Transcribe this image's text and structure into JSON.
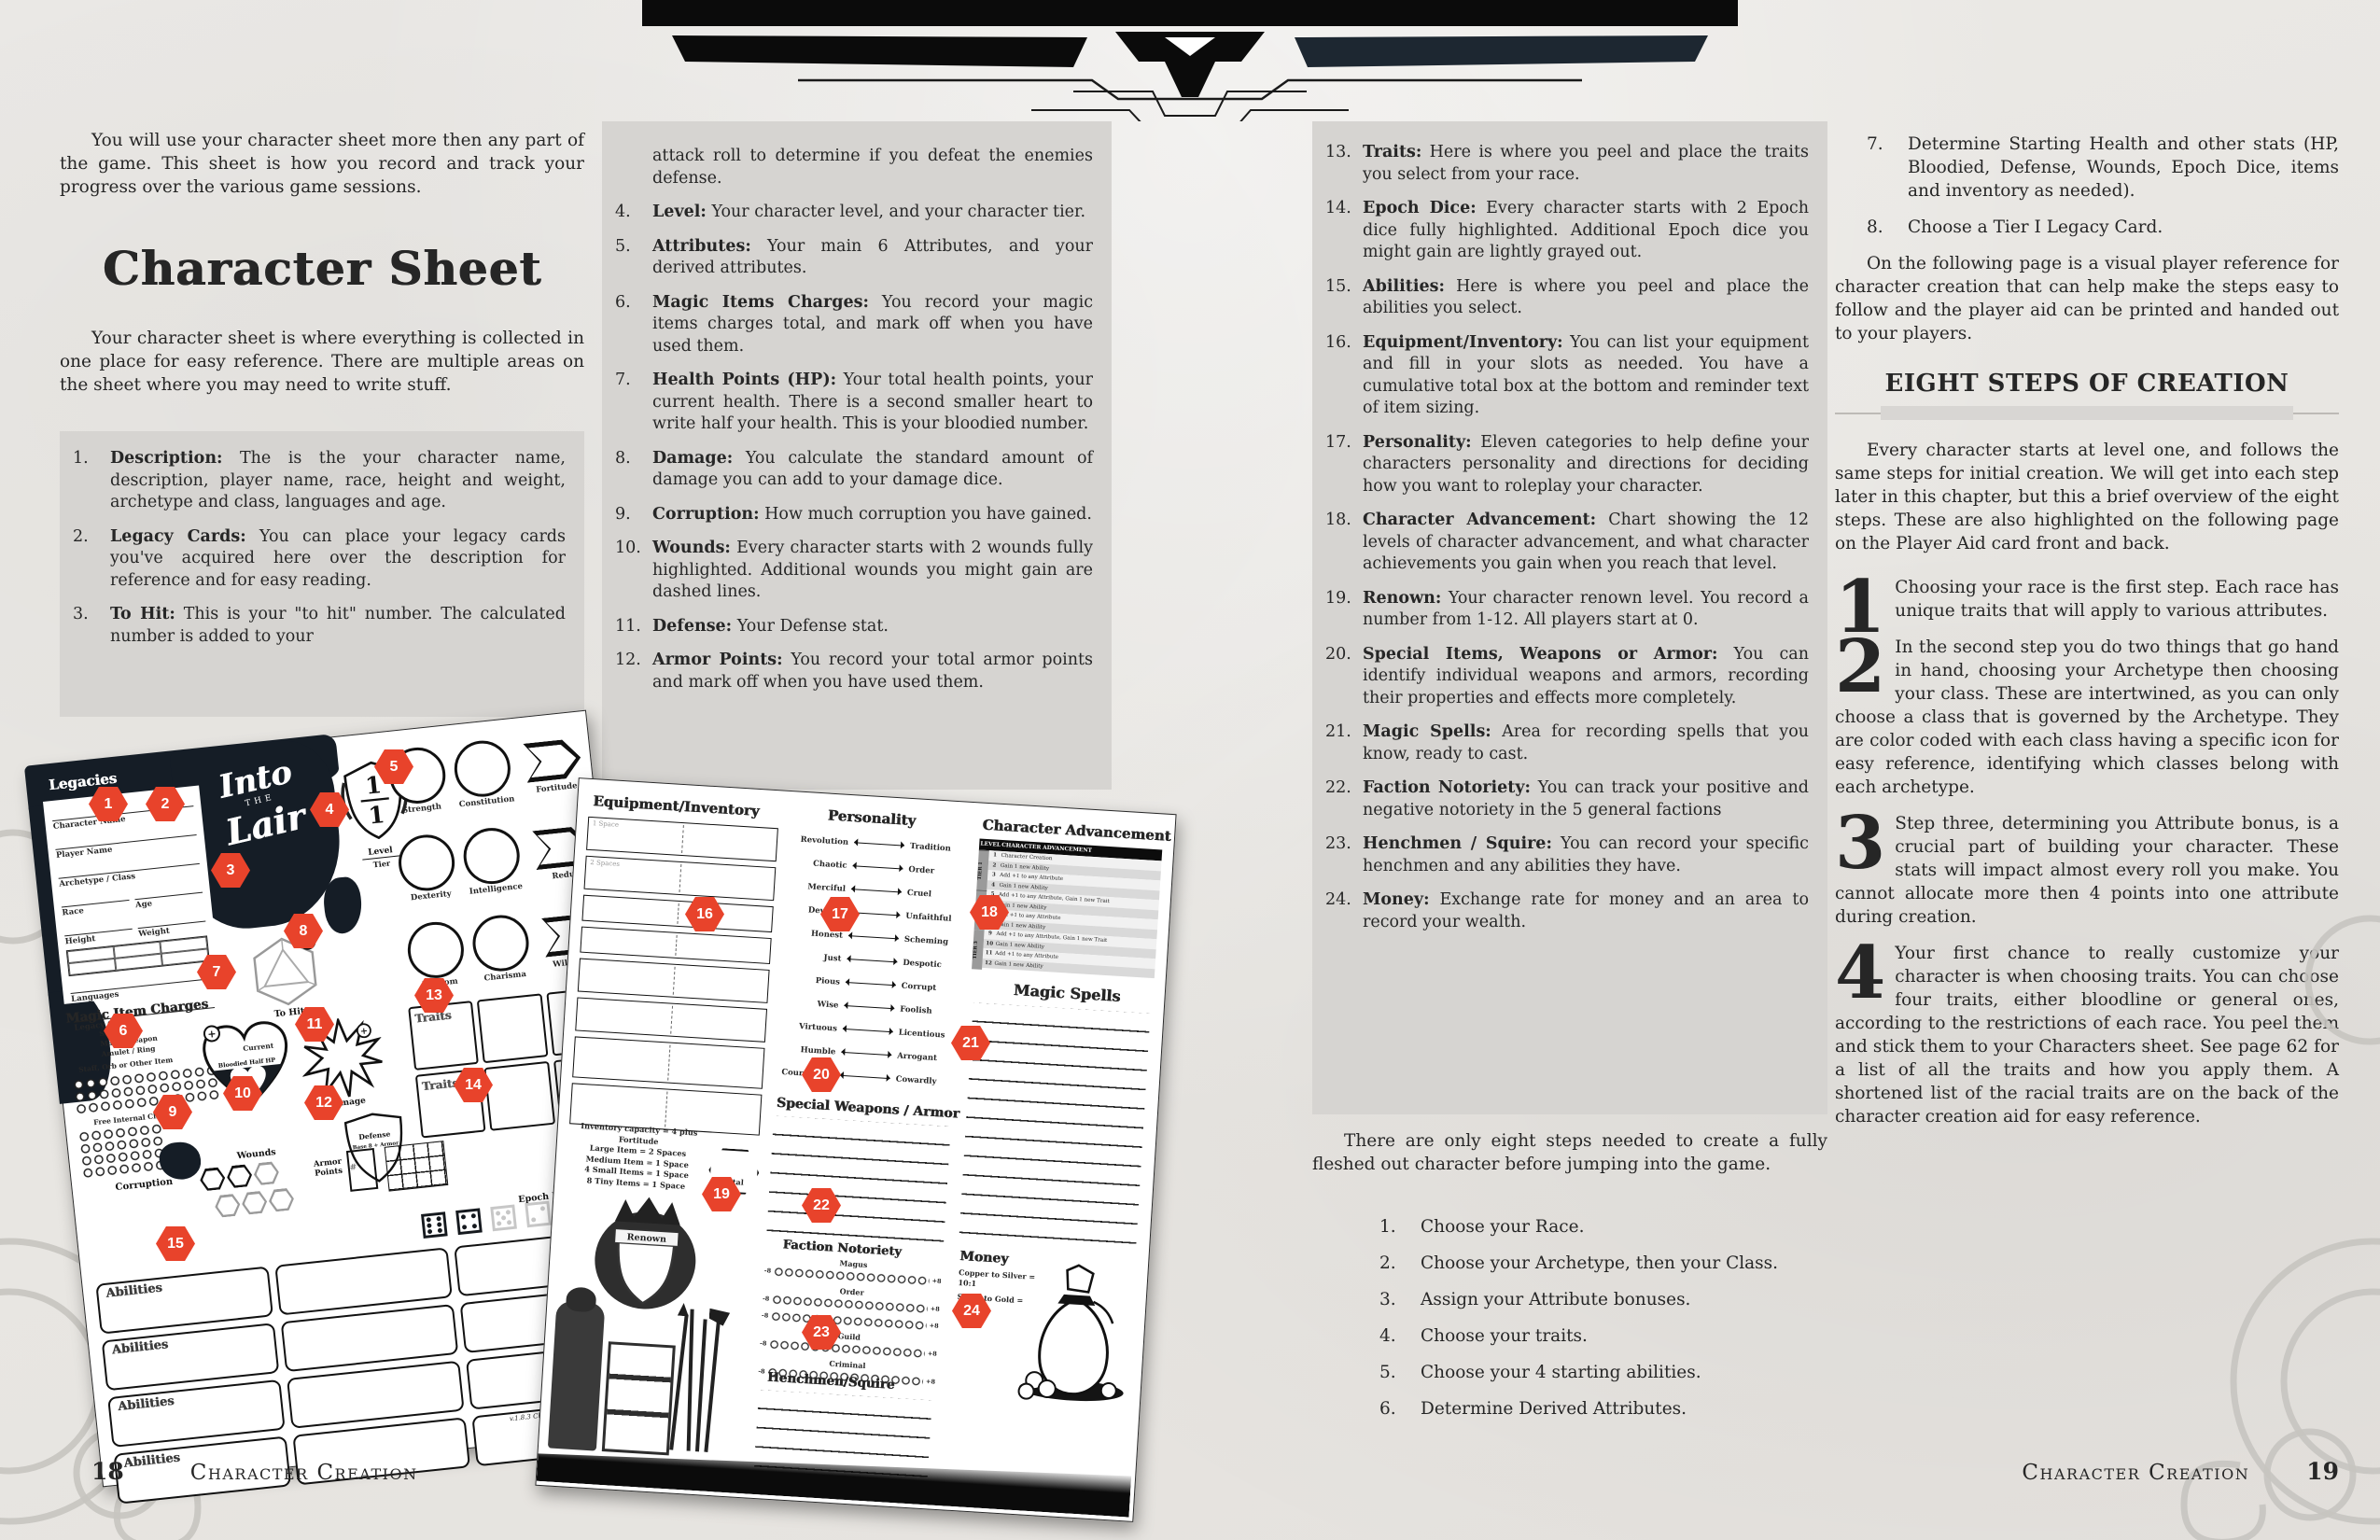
{
  "callouts": [
    "1",
    "2",
    "3",
    "4",
    "5",
    "6",
    "7",
    "8",
    "9",
    "10",
    "11",
    "12",
    "13",
    "14",
    "15",
    "16",
    "17",
    "18",
    "19",
    "20",
    "21",
    "22",
    "23",
    "24"
  ],
  "page18": {
    "number": "18",
    "footer_label": "Character Creation",
    "intro": "You will use your character sheet more then any part of the game. This sheet is how you record and track your progress over the various game sessions.",
    "title": "Character Sheet",
    "after_title": "Your character sheet is where everything is collected in one place for easy reference. There are multiple areas on the sheet where you may need to write stuff.",
    "items": [
      {
        "num": "1.",
        "term": "Description:",
        "text": "The is the your character name, description, player name, race, height and weight, archetype and class, languages and age."
      },
      {
        "num": "2.",
        "term": "Legacy Cards:",
        "text": "You can place your legacy cards you've acquired here over the description for reference and for easy reading."
      },
      {
        "num": "3.",
        "term": "To Hit:",
        "text": "This is your \"to hit\" number. The calculated number is added to your"
      }
    ],
    "items_cont_lead": "attack roll to determine if you defeat the enemies defense.",
    "items2": [
      {
        "num": "4.",
        "term": "Level:",
        "text": "Your character level, and your character tier."
      },
      {
        "num": "5.",
        "term": "Attributes:",
        "text": "Your main 6 Attributes, and your derived attributes."
      },
      {
        "num": "6.",
        "term": "Magic Items Charges:",
        "text": "You record your magic items charges total, and mark off when you have used them."
      },
      {
        "num": "7.",
        "term": "Health Points (HP):",
        "text": "Your total health points, your current health. There is a second smaller heart to write half your health. This is your bloodied number."
      },
      {
        "num": "8.",
        "term": "Damage:",
        "text": "You calculate the standard amount of damage you can add to your damage dice."
      },
      {
        "num": "9.",
        "term": "Corruption:",
        "text": "How much corruption you have gained."
      },
      {
        "num": "10.",
        "term": "Wounds:",
        "text": "Every character starts with 2 wounds fully highlighted. Additional wounds you might gain are dashed lines."
      },
      {
        "num": "11.",
        "term": "Defense:",
        "text": "Your Defense stat."
      },
      {
        "num": "12.",
        "term": "Armor Points:",
        "text": "You record your total armor points and mark off when you have used them."
      }
    ]
  },
  "page19": {
    "number": "19",
    "footer_label": "Character Creation",
    "items": [
      {
        "num": "13.",
        "term": "Traits:",
        "text": "Here is where you peel and place the traits you select from your race."
      },
      {
        "num": "14.",
        "term": "Epoch Dice:",
        "text": "Every character starts with 2 Epoch dice fully highlighted. Additional Epoch dice you might gain are lightly grayed out."
      },
      {
        "num": "15.",
        "term": "Abilities:",
        "text": "Here is where you peel and place the abilities you select."
      },
      {
        "num": "16.",
        "term": "Equipment/Inventory:",
        "text": "You can list your equipment and fill in your slots as needed. You have a cumulative total box at the bottom and reminder text of item sizing."
      },
      {
        "num": "17.",
        "term": "Personality:",
        "text": "Eleven categories to help define your characters personality and directions for deciding how you want to roleplay your character."
      },
      {
        "num": "18.",
        "term": "Character Advancement:",
        "text": "Chart showing the 12 levels of character advancement, and what character achievements you gain when you reach that level."
      },
      {
        "num": "19.",
        "term": "Renown:",
        "text": "Your character renown level. You record a number from 1-12. All players start at 0."
      },
      {
        "num": "20.",
        "term": "Special Items, Weapons or Armor:",
        "text": "You can identify individual weapons and armors, recording their properties and effects more completely."
      },
      {
        "num": "21.",
        "term": "Magic Spells:",
        "text": "Area for recording spells that you know, ready to cast."
      },
      {
        "num": "22.",
        "term": "Faction Notoriety:",
        "text": "You can track your positive and negative notoriety in the 5 general factions"
      },
      {
        "num": "23.",
        "term": "Henchmen / Squire:",
        "text": "You can record your specific henchmen and any abilities they have."
      },
      {
        "num": "24.",
        "term": "Money:",
        "text": "Exchange rate for money and an area to record your wealth."
      }
    ],
    "steps_intro": "There are only eight steps needed to create a fully fleshed out character before jumping into the game.",
    "steps": [
      {
        "num": "1.",
        "text": "Choose your Race."
      },
      {
        "num": "2.",
        "text": "Choose your Archetype, then your Class."
      },
      {
        "num": "3.",
        "text": "Assign your Attribute bonuses."
      },
      {
        "num": "4.",
        "text": "Choose your traits."
      },
      {
        "num": "5.",
        "text": "Choose your 4 starting abilities."
      },
      {
        "num": "6.",
        "text": "Determine Derived Attributes."
      }
    ],
    "steps2": [
      {
        "num": "7.",
        "text": "Determine Starting Health and other stats (HP, Bloodied, Defense, Wounds, Epoch Dice, items and inventory as needed)."
      },
      {
        "num": "8.",
        "text": "Choose a Tier I Legacy Card."
      }
    ],
    "following_para": "On the following page is a visual player reference for character creation that can help make the steps easy to follow and the player aid can be printed and handed out to your players.",
    "section_title": "EIGHT STEPS OF CREATION",
    "section_para": "Every character starts at level one, and follows the same steps for initial creation. We will get into each step later in this chapter, but this a brief overview of the eight steps. These are also highlighted on the following page on the Player Aid card front and back.",
    "numbered_paras": [
      {
        "num": "1",
        "text": "Choosing your race is the first step. Each race has unique traits that will apply to various attributes."
      },
      {
        "num": "2",
        "text": "In the second step you do two things that go hand in hand, choosing your Archetype then choosing your class. These are intertwined, as you can only choose a class that is governed by the Archetype. They are color coded with each class having a specific icon for easy reference, identifying which classes belong with each archetype."
      },
      {
        "num": "3",
        "text": "Step three, determining you Attribute bonus, is a crucial part of building your character. These stats will impact almost every roll you make. You cannot allocate more then 4 points into one attribute during creation."
      },
      {
        "num": "4",
        "text": "Your first chance to really customize your character is when choosing traits. You can choose four traits, either bloodline or general ones, according to the restrictions of each race. You peel them and stick them to your Characters sheet. See page 62 for a list of all the traits and how you apply them. A shortened list of the racial traits are on the back of the character creation aid for easy reference."
      }
    ]
  },
  "sheet_front": {
    "legacies_label": "Legacies",
    "logo_l1": "Into",
    "logo_the": "THE",
    "logo_l2": "Lair",
    "fields": [
      "Character Name",
      "Player Name",
      "Archetype / Class",
      "Race",
      "Age",
      "Height",
      "Weight",
      "Languages",
      "Legacy Cards"
    ],
    "magic_charges_title": "Magic Item Charges",
    "charge_items": [
      "Shards",
      "Magic Weapon",
      "Amulet / Ring",
      "Staff, Orb or Other Item"
    ],
    "free_internal": "Free Internal Charges",
    "corruption_label": "Corruption",
    "to_hit_label": "To Hit",
    "level_value": "1",
    "tier_value": "1",
    "level_label": "Level",
    "tier_label": "Tier",
    "plus": "+",
    "attr_rows": [
      {
        "a": "Strength",
        "b": "Constitution",
        "d": "Fortitude"
      },
      {
        "a": "Dexterity",
        "b": "Intelligence",
        "d": "Redux"
      },
      {
        "a": "Wisdom",
        "b": "Charisma",
        "d": "Willpower"
      }
    ],
    "current_label": "Current",
    "bloodied_label": "Bloodied Half HP",
    "damage_label": "Damage",
    "defense_label": "Defense",
    "defense_sub": "Base 8 + Armor",
    "wounds_label": "Wounds",
    "armor_points_label": "Armor Points",
    "armor_hash": "#",
    "traits_label": "Traits",
    "epoch_dice_label": "Epoch Dice",
    "ability_rows": [
      {
        "label": "Abilities"
      },
      {
        "label": "Abilities"
      },
      {
        "label": "Abilities"
      },
      {
        "label": "Abilities"
      }
    ],
    "version": "v.1.8.3 Character Sheet"
  },
  "sheet_back": {
    "equipment_title": "Equipment/Inventory",
    "space_labels": [
      "1 Space",
      "2 Spaces"
    ],
    "capacity_lines": [
      "Inventory capacity = 4 plus Fortitude",
      "Large Item = 2 Spaces",
      "Medium Item = 1 Space",
      "4 Small Items = 1 Space",
      "8 Tiny Items = 1 Space"
    ],
    "total_label": "Total",
    "personality_title": "Personality",
    "personality_pairs": [
      {
        "l": "Revolution",
        "r": "Tradition"
      },
      {
        "l": "Chaotic",
        "r": "Order"
      },
      {
        "l": "Merciful",
        "r": "Cruel"
      },
      {
        "l": "Devoted",
        "r": "Unfaithful"
      },
      {
        "l": "Honest",
        "r": "Scheming"
      },
      {
        "l": "Just",
        "r": "Despotic"
      },
      {
        "l": "Pious",
        "r": "Corrupt"
      },
      {
        "l": "Wise",
        "r": "Foolish"
      },
      {
        "l": "Virtuous",
        "r": "Licentious"
      },
      {
        "l": "Humble",
        "r": "Arrogant"
      },
      {
        "l": "Courageous",
        "r": "Cowardly"
      }
    ],
    "advancement_title": "Character Advancement",
    "adv_header_level": "LEVEL",
    "adv_header_desc": "CHARACTER ADVANCEMENT",
    "tiers": [
      "TIER 1",
      "TIER 2",
      "TIER 3"
    ],
    "adv_rows": [
      {
        "lv": "1",
        "t": "Character Creation"
      },
      {
        "lv": "2",
        "t": "Gain 1 new Ability"
      },
      {
        "lv": "3",
        "t": "Add +1 to any Attribute"
      },
      {
        "lv": "4",
        "t": "Gain 1 new Ability"
      },
      {
        "lv": "5",
        "t": "Add +1 to any Attribute, Gain 1 new Trait"
      },
      {
        "lv": "6",
        "t": "Gain 1 new Ability"
      },
      {
        "lv": "7",
        "t": "Add +1 to any Attribute"
      },
      {
        "lv": "8",
        "t": "Gain 1 new Ability"
      },
      {
        "lv": "9",
        "t": "Add +1 to any Attribute, Gain 1 new Trait"
      },
      {
        "lv": "10",
        "t": "Gain 1 new Ability"
      },
      {
        "lv": "11",
        "t": "Add +1 to any Attribute"
      },
      {
        "lv": "12",
        "t": "Gain 1 new Ability"
      }
    ],
    "magic_spells_title": "Magic Spells",
    "special_weapons_title": "Special Weapons / Armor",
    "notoriety_title": "Faction Notoriety",
    "factions": [
      {
        "name": "Magus",
        "min": "-8",
        "max": "+8"
      },
      {
        "name": "Order",
        "min": "-8",
        "max": "+8"
      },
      {
        "name": "",
        "min": "-8",
        "max": "+8"
      },
      {
        "name": "Guild",
        "min": "-8",
        "max": "+8"
      },
      {
        "name": "Criminal",
        "min": "-8",
        "max": "+8"
      }
    ],
    "renown_label": "Renown",
    "henchmen_title": "Henchmen/Squire",
    "money_title": "Money",
    "money_lines": [
      "Copper to Silver = 10:1",
      "Silver to Gold = 100:1"
    ]
  }
}
